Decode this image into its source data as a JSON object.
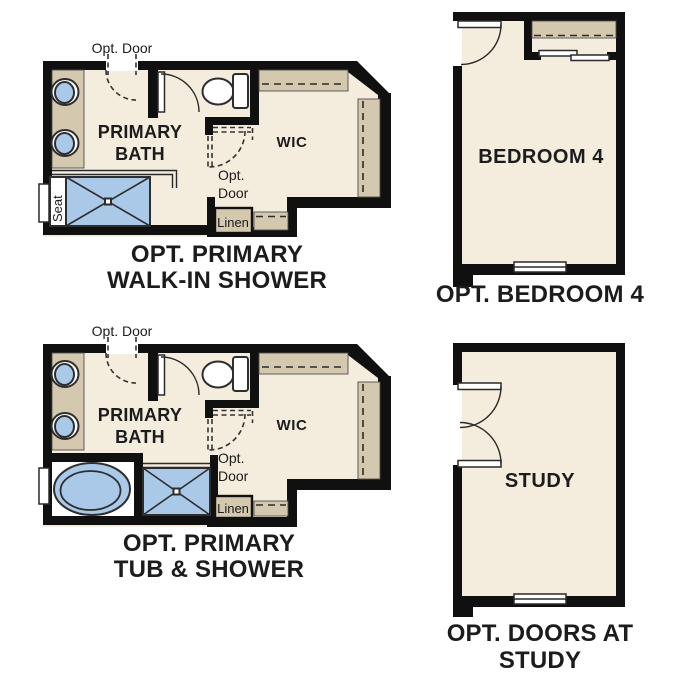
{
  "figure_title": "Floor plan options",
  "colors": {
    "wall": "#101010",
    "floor": "#f4ecdc",
    "cabinet": "#d4c8ae",
    "fixture_fill": "#aac8e8",
    "fixture_stroke": "#2e2e2e",
    "label": "#1c1c1c"
  },
  "plans": {
    "walk_in_shower": {
      "caption": [
        "OPT. PRIMARY",
        "WALK-IN SHOWER"
      ],
      "room": [
        "PRIMARY",
        "BATH"
      ],
      "closet": "WIC",
      "opt_door_entry": "Opt. Door",
      "opt_door_wic": [
        "Opt.",
        "Door"
      ],
      "linen": "Linen",
      "seat": "Seat"
    },
    "bedroom4": {
      "caption": "OPT. BEDROOM 4",
      "room": "BEDROOM 4"
    },
    "tub_shower": {
      "caption": [
        "OPT. PRIMARY",
        "TUB & SHOWER"
      ],
      "room": [
        "PRIMARY",
        "BATH"
      ],
      "closet": "WIC",
      "opt_door_entry": "Opt. Door",
      "opt_door_wic": [
        "Opt.",
        "Door"
      ],
      "linen": "Linen"
    },
    "study": {
      "caption": [
        "OPT. DOORS AT",
        "STUDY"
      ],
      "room": "STUDY"
    }
  }
}
